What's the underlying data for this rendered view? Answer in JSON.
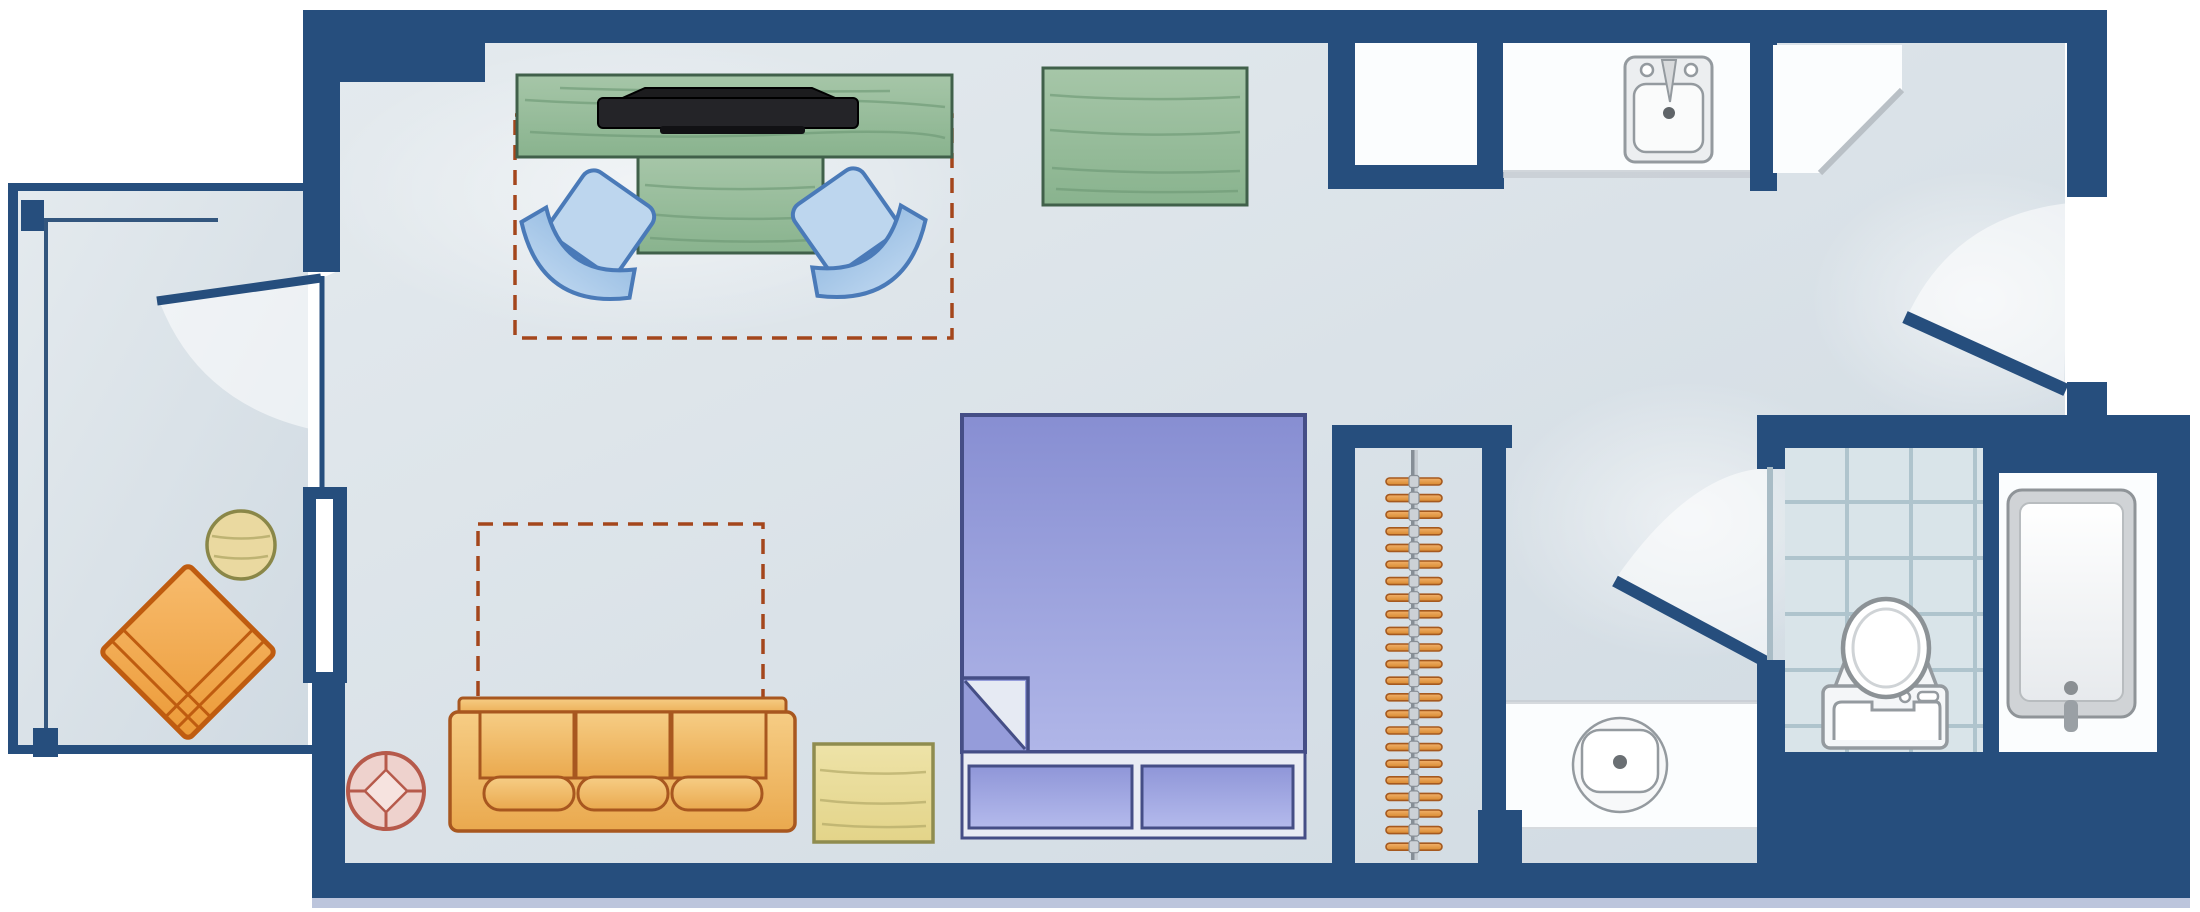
{
  "meta": {
    "title": "Studio guest room floor plan",
    "view": "top-down architectural plan",
    "has_text": false
  },
  "palette": {
    "wall": "#264e7d",
    "wallEdge": "#16325a",
    "white": "#fbfdfe",
    "tile": "#d9e4e9",
    "tileLine": "#afc4cd",
    "greenDark": "#40604a",
    "greenStreak": "#6f9976",
    "blueChairDark": "#4a7ab8",
    "tanDark": "#a8571f",
    "orangeDark": "#bf5c10",
    "bedDark": "#454e86",
    "bedLinen": "#e9ecf4",
    "hangerDark": "#a5591f",
    "dash": "#a4461c",
    "fixture": "#949a9f",
    "fixtureFill": "#f4f6f8",
    "pink": "#eed2cd",
    "pinkDark": "#b65a4b",
    "accentStrip": "#bcc5dc"
  },
  "rooms": [
    {
      "id": "balcony",
      "label": "Balcony",
      "features": [
        "railing",
        "corner posts",
        "patio chair",
        "round side table",
        "swing door"
      ]
    },
    {
      "id": "main-room",
      "label": "Studio living / sleeping area",
      "features": [
        "queen bed",
        "sofa",
        "desk-and-tv area",
        "dining table with two chairs",
        "dressers"
      ]
    },
    {
      "id": "kitchenette",
      "label": "Kitchenette",
      "features": [
        "counter with sink",
        "corner counter",
        "wall niche"
      ]
    },
    {
      "id": "closet",
      "label": "Closet",
      "features": [
        "hanging rod",
        "hangers"
      ]
    },
    {
      "id": "vanity-nook",
      "label": "Vanity nook",
      "features": [
        "vanity counter with round sink"
      ]
    },
    {
      "id": "water-closet",
      "label": "Toilet room (tiled)",
      "features": [
        "toilet",
        "tiled floor"
      ]
    },
    {
      "id": "tub-room",
      "label": "Bathtub room",
      "features": [
        "bathtub"
      ]
    },
    {
      "id": "entry",
      "label": "Entry vestibule",
      "features": [
        "entry door with swing"
      ]
    }
  ],
  "furniture": [
    {
      "id": "tv-console",
      "label": "TV console (green wood)",
      "bbox": [
        517,
        75,
        952,
        157
      ]
    },
    {
      "id": "tv",
      "label": "Flat-screen TV",
      "bbox": [
        598,
        88,
        858,
        133
      ]
    },
    {
      "id": "dining-table",
      "label": "Table (green wood)",
      "bbox": [
        638,
        157,
        823,
        253
      ]
    },
    {
      "id": "chair-left",
      "label": "Upholstered chair",
      "center": [
        595,
        232
      ]
    },
    {
      "id": "chair-right",
      "label": "Upholstered chair",
      "center": [
        852,
        230
      ]
    },
    {
      "id": "dresser",
      "label": "Dresser (green wood)",
      "bbox": [
        1043,
        68,
        1247,
        205
      ]
    },
    {
      "id": "desk-area-outline",
      "label": "Dashed clearance outline (desk/table zone)",
      "bbox": [
        515,
        115,
        952,
        338
      ]
    },
    {
      "id": "sofa",
      "label": "Three-seat sofa",
      "bbox": [
        450,
        698,
        795,
        831
      ]
    },
    {
      "id": "sofa-bed-outline",
      "label": "Dashed pull-out sofa-bed outline",
      "bbox": [
        478,
        524,
        763,
        700
      ]
    },
    {
      "id": "coffee-table",
      "label": "Coffee table (pale wood)",
      "bbox": [
        814,
        744,
        933,
        842
      ]
    },
    {
      "id": "side-table-round",
      "label": "Round pedestal table",
      "center": [
        386,
        791
      ],
      "radius": 38
    },
    {
      "id": "bed",
      "label": "Bed with folded sheet and foot bench",
      "bbox": [
        962,
        415,
        1305,
        838
      ]
    },
    {
      "id": "balcony-chair",
      "label": "Patio chair (angled 45°)",
      "center": [
        188,
        652
      ]
    },
    {
      "id": "balcony-table",
      "label": "Round patio table",
      "center": [
        241,
        545
      ],
      "radius": 34
    }
  ],
  "fixtures": [
    {
      "id": "kitchen-sink",
      "label": "Kitchenette sink",
      "bbox": [
        1625,
        57,
        1712,
        162
      ]
    },
    {
      "id": "vanity-sink",
      "label": "Round vanity sink",
      "center": [
        1620,
        765
      ],
      "radius": 47
    },
    {
      "id": "toilet",
      "label": "Toilet",
      "bbox": [
        1823,
        600,
        1947,
        748
      ]
    },
    {
      "id": "bathtub",
      "label": "Bathtub",
      "bbox": [
        2008,
        490,
        2135,
        717
      ]
    }
  ],
  "closet": {
    "hanger_count": 23,
    "hanger_start_y": 478,
    "hanger_step": 16.6,
    "rod_x": 1414
  },
  "doors": [
    {
      "id": "balcony-door",
      "label": "Balcony door (open leaf)"
    },
    {
      "id": "bathroom-door",
      "label": "Bathroom door (open leaf)"
    },
    {
      "id": "entry-door",
      "label": "Entry door (open leaf)"
    }
  ]
}
